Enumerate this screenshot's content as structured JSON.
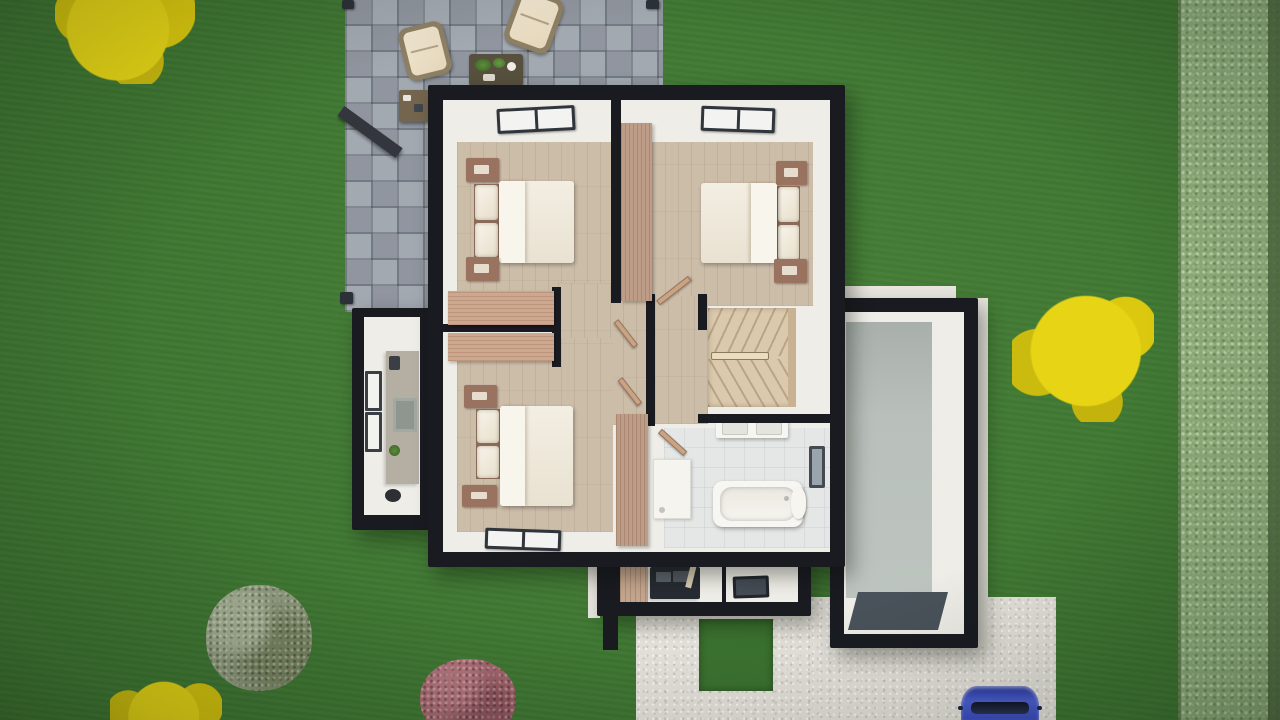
{
  "scene": {
    "title": "Top-down 3D architectural render of an upper-floor house plan set in a lawn garden",
    "view": "top-down aerial",
    "visible_text": "none"
  },
  "colors": {
    "grass": "#3d7531",
    "hedge": "#8fad7d",
    "hedge_edge": "#4f6b40",
    "paver_gray": "#9aa0a9",
    "wall_dark": "#191b21",
    "interior_white": "#efede7",
    "wood_floor": "#ccbda9",
    "wardrobe_wood": "#bd9d87",
    "desk_wood": "#cda890",
    "nightstand_wood": "#9a7360",
    "bed_linen": "#f1ebde",
    "stairs_wood": "#dbc9ad",
    "bath_tile": "#e4e7e5",
    "kitchen_counter": "#b5afa3",
    "garage_floor": "#b9c0bb",
    "garage_mat": "#49525a",
    "concrete": "#e6e3dc",
    "car_blue": "#3c4ec5",
    "bush_yellow": "#e3d214",
    "bush_olive": "#8f9a7d",
    "bush_red": "#a4656d",
    "chair_cushion": "#ecdfc6",
    "window_frame": "#30353c"
  },
  "garden": {
    "lawn": "green grass covering full scene with vignette",
    "hedge": "light textured hedge strip along right edge",
    "plants": [
      {
        "name": "yellow-tree",
        "position": "top-left corner"
      },
      {
        "name": "yellow-tree",
        "position": "right of house"
      },
      {
        "name": "yellow-bush",
        "position": "bottom-left edge"
      },
      {
        "name": "olive-green-bush",
        "position": "bottom-left"
      },
      {
        "name": "red-maroon-bush",
        "position": "bottom-center edge"
      }
    ],
    "patio": {
      "material": "gray stone pavers",
      "items": [
        "wicker lounge chair",
        "wicker lounge chair",
        "coffee table with plants",
        "wood sideboard",
        "pergola posts",
        "pergola beam"
      ]
    },
    "driveway": {
      "material": "white speckled concrete",
      "items": [
        "grass inset square",
        "blue car at bottom edge"
      ]
    }
  },
  "house": {
    "floor_shown": "upper floor",
    "rooms": [
      {
        "name": "bedroom-top-left",
        "floor": "wood",
        "items": [
          "double bed",
          "2 nightstands",
          "desk",
          "window in top wall"
        ]
      },
      {
        "name": "bedroom-top-right",
        "floor": "wood",
        "items": [
          "double bed",
          "2 nightstands",
          "wardrobe",
          "window in top wall"
        ]
      },
      {
        "name": "bedroom-bottom-left",
        "floor": "wood",
        "items": [
          "double bed",
          "2 nightstands",
          "desk",
          "wardrobe",
          "window in bottom wall"
        ]
      },
      {
        "name": "hallway-landing",
        "floor": "wood",
        "items": [
          "open doors"
        ]
      },
      {
        "name": "staircase",
        "type": "winder stairs with railing"
      },
      {
        "name": "bathroom",
        "floor": "tile",
        "items": [
          "bathtub",
          "double-sink vanity",
          "shower tray",
          "toilet",
          "wall mirror"
        ]
      },
      {
        "name": "kitchenette-annex",
        "position": "left",
        "items": [
          "counter",
          "sink",
          "toaster",
          "plant",
          "pot",
          "2 windows"
        ]
      },
      {
        "name": "garage-annex",
        "position": "right",
        "items": [
          "gray concrete floor",
          "dark floor mat"
        ]
      },
      {
        "name": "lower-level-rooms",
        "position": "bottom",
        "items": [
          "wood cabinet",
          "dark counter",
          "skylight"
        ]
      }
    ]
  }
}
